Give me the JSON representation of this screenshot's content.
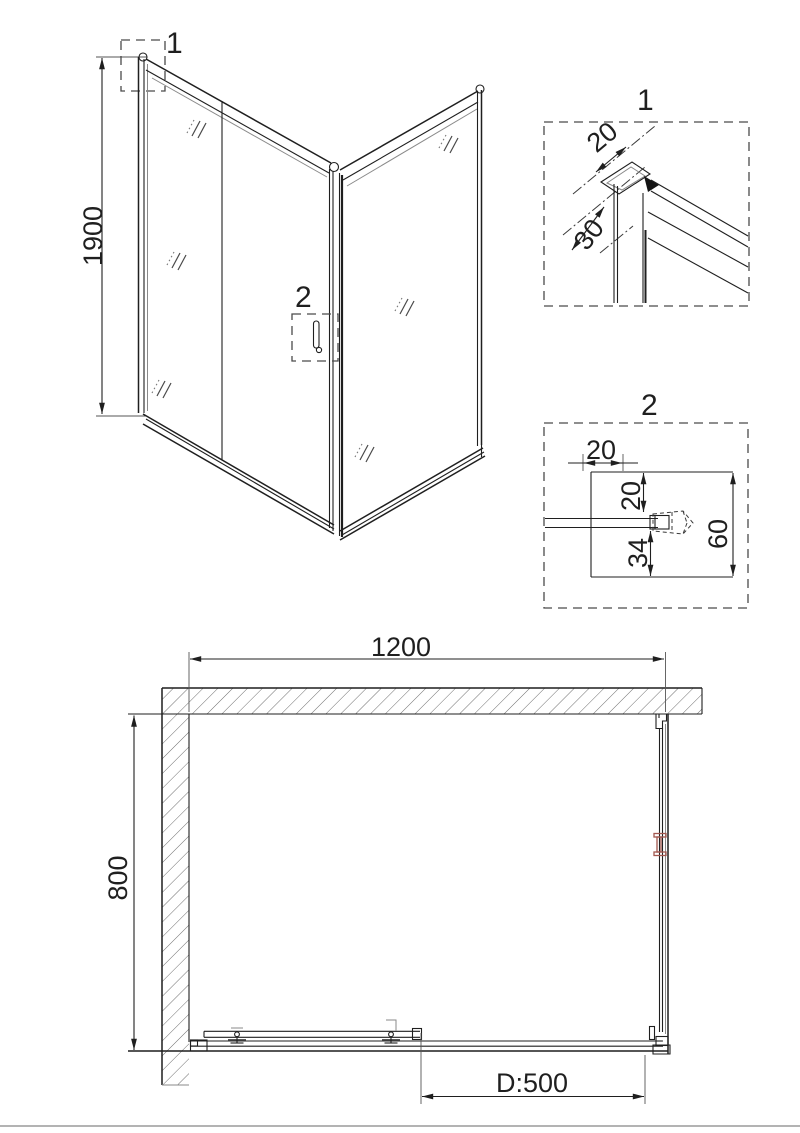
{
  "drawing": {
    "elevation": {
      "callout_top": "1",
      "callout_handle": "2",
      "dim_height": "1900"
    },
    "detail1": {
      "title": "1",
      "dim_profile": "20",
      "dim_depth": "30"
    },
    "detail2": {
      "title": "2",
      "dim_width": "20",
      "dim_top": "20",
      "dim_bottom": "34",
      "dim_height": "60"
    },
    "plan": {
      "dim_width": "1200",
      "dim_depth": "800",
      "dim_door": "D:500"
    },
    "colors": {
      "line": "#1f1f1f",
      "accent_red": "#a2574f"
    }
  }
}
